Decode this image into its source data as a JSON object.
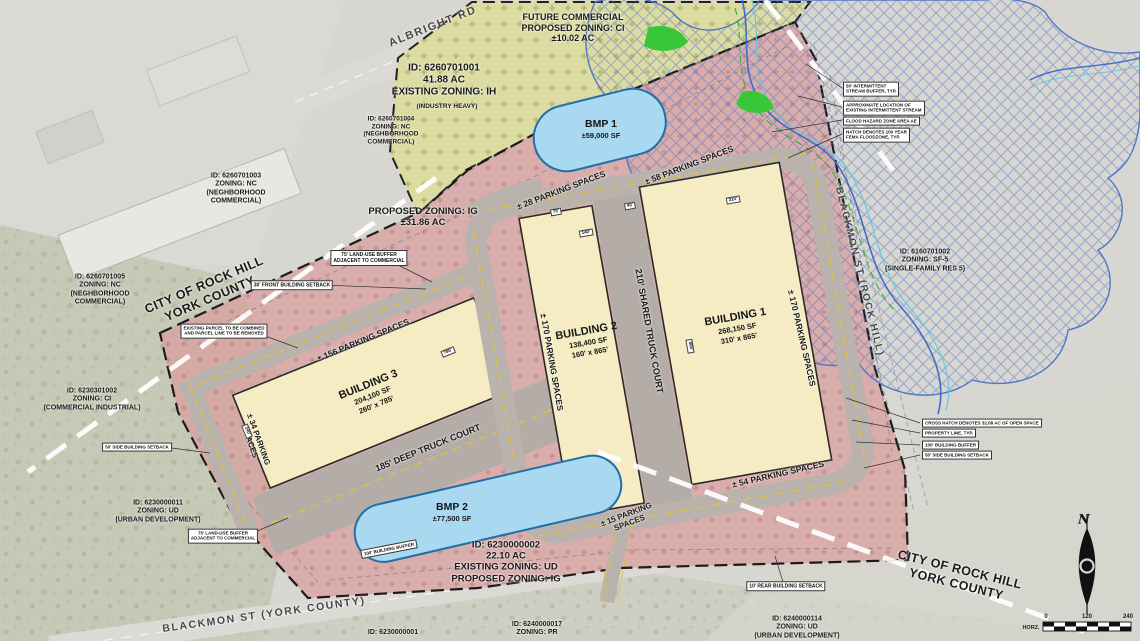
{
  "colors": {
    "parcel_pink": "#d8a3a1",
    "parcel_olive": "#dcdca2",
    "building": "#f6ecc4",
    "pond": "#a9d9f0",
    "flood_hatch": "#4f78c8",
    "road_gray": "#b9b2ad",
    "lane_yellow": "#e2c23a",
    "boundary_white": "#ffffff"
  },
  "roads": {
    "albright": "ALBRIGHT RD",
    "blackmon_county": "BLACKMON ST (YORK COUNTY)",
    "blackmon_city": "BLACKMON ST (ROCK HILL)"
  },
  "city_boundary_label": "CITY OF ROCK HILL\nYORK COUNTY",
  "zones": {
    "future_commercial": "FUTURE COMMERCIAL\nPROPOSED ZONING: CI\n±10.02 AC",
    "ih_parcel": "ID: 6260701001\n41.88 AC\nEXISTING ZONING: IH",
    "ih_parcel_sub": "(INDUSTRY HEAVY)",
    "ig_parcel": "PROPOSED ZONING: IG\n±31.86 AC",
    "main_parcel": "ID: 6230000002\n22.10 AC\nEXISTING ZONING: UD\nPROPOSED ZONING: IG"
  },
  "neighbors": [
    {
      "text": "ID: 6260701004\nZONING: NC\n(NEGHBORHOOD\nCOMMERCIAL)"
    },
    {
      "text": "ID: 6260701003\nZONING: NC\n(NEGHBORHOOD\nCOMMERCIAL)"
    },
    {
      "text": "ID: 6260701005\nZONING: NC\n(NEGHBORHOOD\nCOMMERCIAL)"
    },
    {
      "text": "ID: 6230301002\nZONING: CI\n(COMMERCIAL INDUSTRIAL)"
    },
    {
      "text": "ID: 6230000011\nZONING: UD\n(URBAN DEVELOPMENT)"
    },
    {
      "text": "ID: 6160701002\nZONING: SF-5\n(SINGLE-FAMILY RES 5)"
    },
    {
      "text": "ID: 6230000001"
    },
    {
      "text": "ID: 6240000017\nZONING: PR"
    },
    {
      "text": "ID: 6240000114\nZONING: UD\n(URBAN DEVELOPMENT)"
    }
  ],
  "buildings": [
    {
      "name": "BUILDING 1",
      "sf": "268,150 SF",
      "dims": "310' x 865'"
    },
    {
      "name": "BUILDING 2",
      "sf": "138,400 SF",
      "dims": "160' x 865'"
    },
    {
      "name": "BUILDING 3",
      "sf": "204,100 SF",
      "dims": "260' x 785'"
    }
  ],
  "bmps": [
    {
      "name": "BMP 1",
      "sf": "±59,000 SF"
    },
    {
      "name": "BMP 2",
      "sf": "±77,500 SF"
    }
  ],
  "truck_courts": {
    "shared": "210' SHARED TRUCK COURT",
    "deep": "185' DEEP TRUCK COURT"
  },
  "parking": {
    "p28": "± 28 PARKING SPACES",
    "p58": "± 58 PARKING SPACES",
    "p156": "± 156 PARKING SPACES",
    "p170_west": "± 170 PARKING SPACES",
    "p170_east": "± 170 PARKING SPACES",
    "p34": "± 34 PARKING\nSPACES",
    "p15": "± 15 PARKING\nSPACES",
    "p54": "± 54 PARKING SPACES"
  },
  "notes": {
    "combine": "EXISTING PARCEL TO BE COMBINED\nAND PARCEL LINE TO BE REMOVED",
    "buffer75_north": "75' LAND-USE BUFFER\nADJACENT TO COMMERCIAL",
    "buffer75_south": "75' LAND-USE BUFFER\nADJACENT TO COMMERCIAL",
    "setback_front": "30' FRONT BUILDING SETBACK",
    "setback_rear": "10' REAR BUILDING SETBACK",
    "setback_side_left": "50' SIDE BUILDING SETBACK",
    "buffer100_bmp2": "100' BUILDING BUFFER"
  },
  "callouts_flood": [
    "50' INTERMITTENT\nSTREAM BUFFER, TYP.",
    "APPROXIMATE LOCATION OF\nEXISTING INTERMITTENT STREAM",
    "FLOOD HAZARD ZONE AREA AE",
    "HATCH DENOTES 100 YEAR\nFEMA FLOODZONE, TYP."
  ],
  "callouts_property": [
    "CROSS HATCH DENOTES 32.08 AC OF OPEN SPACE",
    "PROPERTY LINE, TYP.",
    "100' BUILDING BUFFER",
    "50' SIDE BUILDING SETBACK"
  ],
  "dims": [
    "140'",
    "75'",
    "310'",
    "865'",
    "785'",
    "240'",
    "40'"
  ],
  "north_label": "N",
  "scale": {
    "ticks": [
      "0",
      "120",
      "240"
    ],
    "label": "HORZ."
  }
}
